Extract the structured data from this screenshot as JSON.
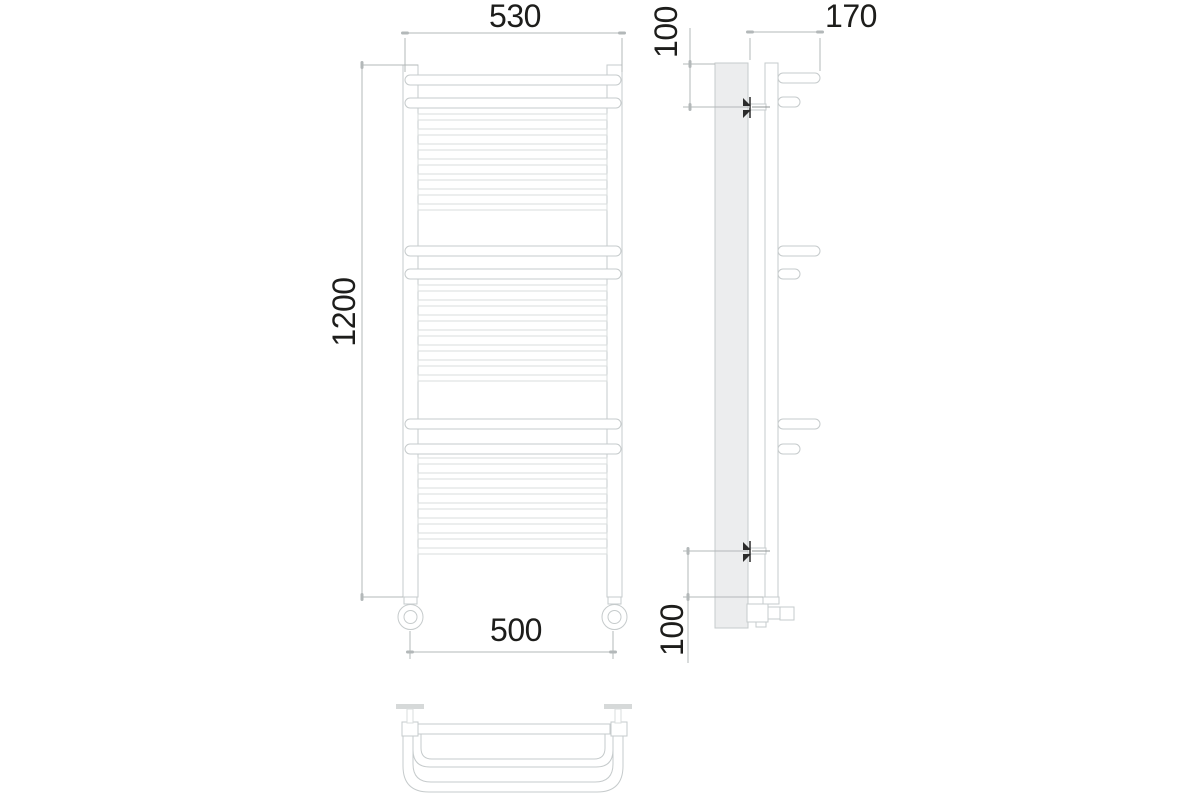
{
  "drawing": {
    "subject": "three-view technical drawing of a ladder towel rail",
    "dimensions": {
      "front_top_width": "530",
      "front_height": "1200",
      "front_bottom_width": "500",
      "side_top_bracket_offset": "100",
      "side_depth": "170",
      "side_bottom_bracket_offset": "100"
    },
    "colors": {
      "background": "#ffffff",
      "outline": "#c6cbcc",
      "outline_soft": "#d9dddd",
      "dimension_line": "#b3b8b9",
      "dimension_text": "#1d1d1b",
      "bracket_accent": "#2b2b2b",
      "panel_fill": "#ecedee"
    }
  }
}
